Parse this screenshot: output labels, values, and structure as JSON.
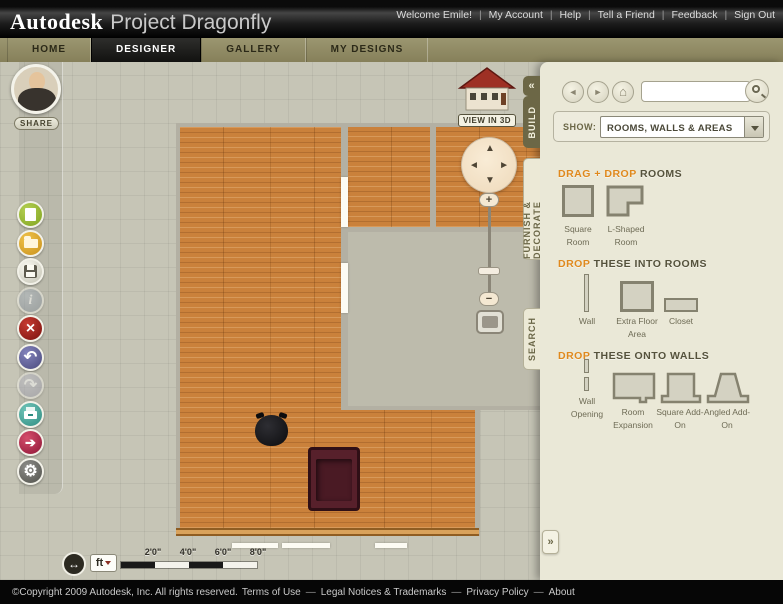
{
  "header": {
    "brand": "Autodesk",
    "product": "Project Dragonfly",
    "greeting": "Welcome Emile!",
    "sep": "|",
    "links": [
      "My Account",
      "Help",
      "Tell a Friend",
      "Feedback",
      "Sign Out"
    ]
  },
  "nav": {
    "tabs": [
      {
        "label": "HOME"
      },
      {
        "label": "DESIGNER"
      },
      {
        "label": "GALLERY"
      },
      {
        "label": "MY DESIGNS"
      }
    ],
    "active_tab": "DESIGNER"
  },
  "sidebar": {
    "share_label": "SHARE",
    "tools": [
      {
        "name": "new-design"
      },
      {
        "name": "open-design"
      },
      {
        "name": "save-design"
      },
      {
        "name": "info",
        "disabled": true
      },
      {
        "name": "delete"
      },
      {
        "name": "undo"
      },
      {
        "name": "redo",
        "disabled": true
      },
      {
        "name": "print"
      },
      {
        "name": "share-design"
      },
      {
        "name": "settings"
      }
    ]
  },
  "icons": {
    "info": "i",
    "close": "×",
    "undo": "↶",
    "redo": "↷",
    "forward": "➔",
    "gear": "⚙",
    "measure": "↔",
    "back": "◄",
    "fwd": "►",
    "home": "⌂",
    "up": "▲",
    "down": "▼",
    "left": "◄",
    "right": "►",
    "plus": "+",
    "minus": "−",
    "collapse": "«",
    "expand": "»"
  },
  "canvas": {
    "view_3d_label": "VIEW IN 3D",
    "unit_label": "ft",
    "ruler_labels": [
      "2'0\"",
      "4'0\"",
      "6'0\"",
      "8'0\""
    ]
  },
  "panel": {
    "tabs": [
      {
        "label": "BUILD",
        "active": true
      },
      {
        "label": "FURNISH & DECORATE",
        "active": false
      },
      {
        "label": "SEARCH",
        "active": false
      }
    ],
    "search_value": "",
    "show_label": "SHOW:",
    "show_value": "ROOMS, WALLS & AREAS",
    "sections": [
      {
        "accent": "DRAG + DROP",
        "rest": "ROOMS",
        "items": [
          {
            "label": "Square Room"
          },
          {
            "label": "L-Shaped Room"
          }
        ]
      },
      {
        "accent": "DROP",
        "rest": "THESE INTO ROOMS",
        "items": [
          {
            "label": "Wall"
          },
          {
            "label": "Extra Floor Area"
          },
          {
            "label": "Closet"
          }
        ]
      },
      {
        "accent": "DROP",
        "rest": "THESE ONTO WALLS",
        "items": [
          {
            "label": "Wall Opening"
          },
          {
            "label": "Room Expansion"
          },
          {
            "label": "Square Add-On"
          },
          {
            "label": "Angled Add-On"
          }
        ]
      }
    ]
  },
  "footer": {
    "copyright": "©Copyright 2009 Autodesk, Inc. All rights reserved.",
    "sep": "—",
    "links": [
      "Terms of Use",
      "Legal Notices & Trademarks",
      "Privacy Policy",
      "About"
    ]
  },
  "colors": {
    "accent_orange": "#e0891d",
    "nav_olive": "#8e8963",
    "panel_cream": "#eae8d7",
    "wood_floor": "#ca813b",
    "wall_grey": "#b3b0a3",
    "active_tab_olive": "#6c6746"
  }
}
